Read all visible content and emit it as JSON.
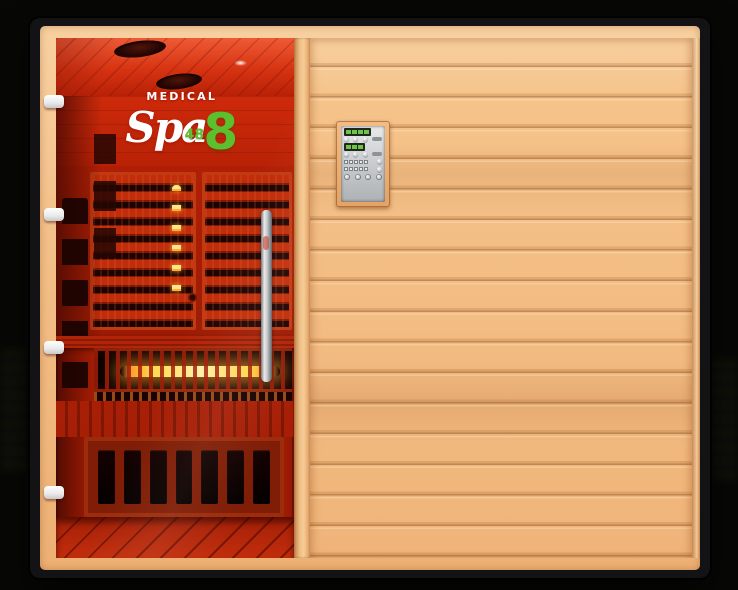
{
  "image": {
    "description": "Infrared sauna cabin product photo with red chromotherapy-lit interior",
    "style": "studio shot on black background"
  },
  "logo": {
    "brand": "MEDICAL",
    "script_word": "Spa",
    "model_number_small": "48",
    "model_number_large": "8"
  },
  "colors": {
    "background": "#070705",
    "frame_black": "#141416",
    "wood_light": "#f3bd85",
    "wood_groove": "#d6935b",
    "interior_red_bright": "#e04a22",
    "interior_red_deep": "#8e1a04",
    "heater_glow_yellow": "#ffd84d",
    "heater_glow_orange": "#ff9d2e",
    "logo_green": "#5cbf2d",
    "logo_white": "#ffffff",
    "control_panel_silver": "#ced0d2",
    "hinge_white": "#f2f2f3"
  },
  "parts": {
    "glass_door": "full-length glass door showing red-lit interior",
    "door_handle": "vertical stainless steel handle",
    "hinge_count": 4,
    "ceiling_vent_count": 2,
    "rear_heater_panel_count": 2,
    "front_heater": "glowing full-spectrum heating element under bench",
    "under_bench_vent_count": 7,
    "control_panel": "wall-mounted digital control panel",
    "wood_wall": "horizontal tongue-and-groove planks"
  }
}
